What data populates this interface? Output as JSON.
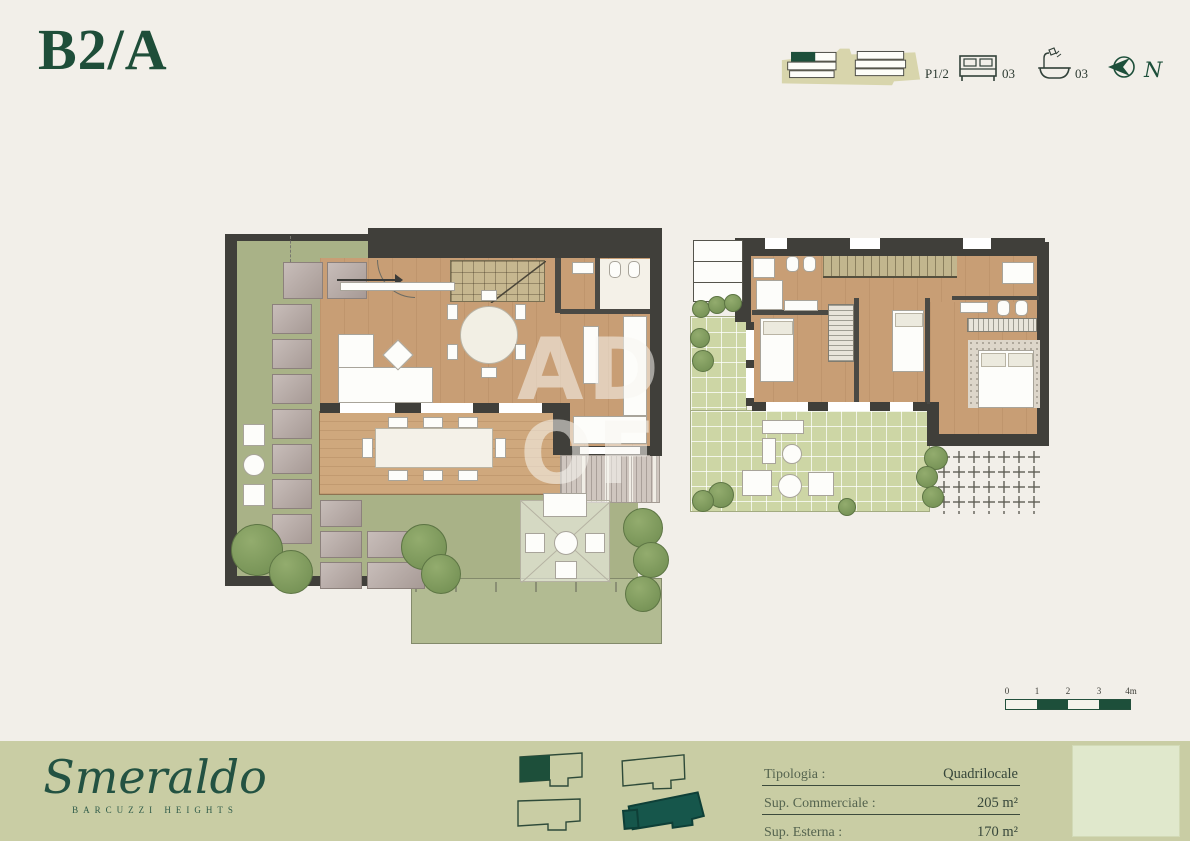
{
  "page": {
    "title": "B2/A",
    "background_color": "#f2efe9"
  },
  "header": {
    "unit_code": "B2/A",
    "locator_icon": "building-locator-icon",
    "floor_label": "P1/2",
    "bedrooms_icon": "bed-icon",
    "bedrooms_count": "03",
    "bathrooms_icon": "bath-icon",
    "bathrooms_count": "03",
    "north_icon": "north-compass-icon",
    "north_label": "N"
  },
  "plans": {
    "left": {
      "description": "ground floor with living area, kitchen, deck and private garden"
    },
    "right": {
      "description": "upper floor with three bedrooms, two bathrooms and tiled terrace"
    }
  },
  "watermark": {
    "line1": "AD",
    "line2": "OF"
  },
  "scale_bar": {
    "labels": [
      "0",
      "1",
      "2",
      "3",
      "4m"
    ]
  },
  "footer": {
    "brand": {
      "name": "Smeraldo",
      "subtitle": "BARCUZZI HEIGHTS"
    },
    "specs": {
      "rows": [
        {
          "label": "Tipologia :",
          "value": "Quadrilocale"
        },
        {
          "label": "Sup. Commerciale :",
          "value": "205 m²"
        },
        {
          "label": "Sup. Esterna :",
          "value": "170 m²"
        }
      ]
    }
  },
  "colors": {
    "brand_green": "#1d4f3a",
    "sage_band": "#c9cda4",
    "teal_shape": "#16564b",
    "cream_background": "#f2efe9"
  }
}
